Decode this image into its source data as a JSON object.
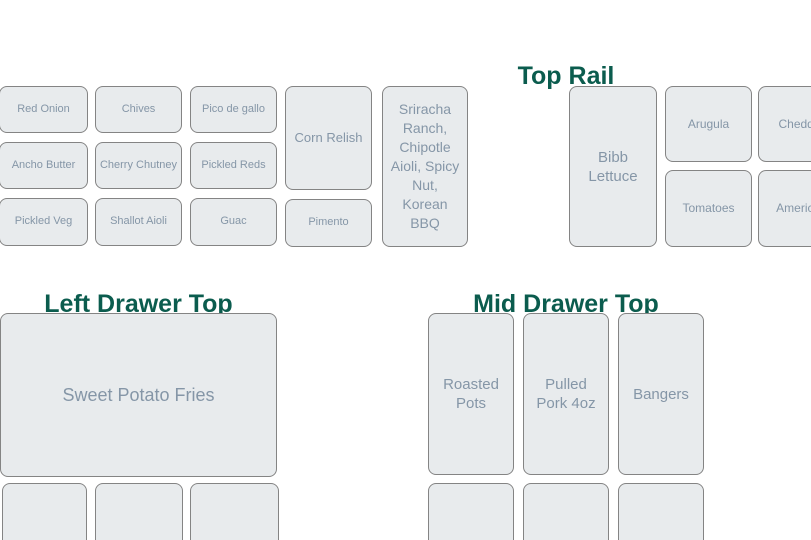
{
  "colors": {
    "background": "#ffffff",
    "box_fill": "#e8ebed",
    "box_border": "#848484",
    "box_text": "#8596a7",
    "heading_text": "#0b5c4e"
  },
  "condiments": {
    "red_onion": "Red Onion",
    "chives": "Chives",
    "pico_de_gallo": "Pico de gallo",
    "ancho_butter": "Ancho Butter",
    "cherry_chutney": "Cherry Chutney",
    "pickled_reds": "Pickled Reds",
    "pickled_veg": "Pickled Veg",
    "shallot_aioli": "Shallot Aioli",
    "guac": "Guac",
    "corn_relish": "Corn Relish",
    "pimento": "Pimento",
    "sauces": "Sriracha Ranch, Chipotle Aioli, Spicy Nut, Korean BBQ"
  },
  "top_rail": {
    "title": "Top Rail",
    "bibb_lettuce": "Bibb Lettuce",
    "arugula": "Arugula",
    "cheddar": "Cheddar",
    "tomatoes": "Tomatoes",
    "american": "American"
  },
  "left_drawer": {
    "title": "Left Drawer Top",
    "sweet_potato_fries": "Sweet Potato Fries",
    "empty_slot_count": 3
  },
  "mid_drawer": {
    "title": "Mid Drawer Top",
    "roasted_pots": "Roasted Pots",
    "pulled_pork": "Pulled Pork 4oz",
    "bangers": "Bangers",
    "empty_slot_count": 3
  }
}
